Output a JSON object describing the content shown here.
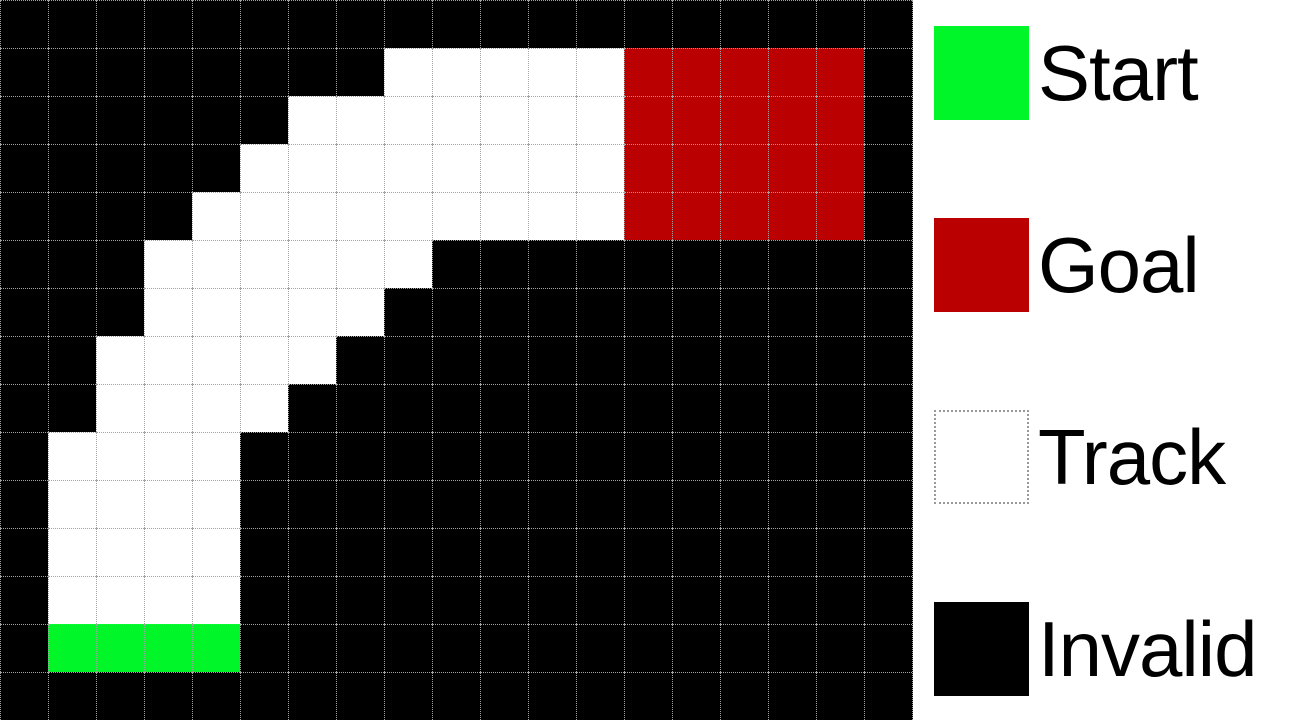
{
  "colors": {
    "start": "#00F629",
    "goal": "#BA0000",
    "track": "#FFFFFF",
    "invalid": "#000000",
    "gridline": "#A3A3A3",
    "legend_background": "#FFFFFF"
  },
  "legend": {
    "items": [
      {
        "label": "Start",
        "color_key": "start"
      },
      {
        "label": "Goal",
        "color_key": "goal"
      },
      {
        "label": "Track",
        "color_key": "track"
      },
      {
        "label": "Invalid",
        "color_key": "invalid"
      }
    ]
  },
  "grid": {
    "cols": 19,
    "rows": 15,
    "cell_size": 48,
    "cell_legend": {
      "B": "invalid",
      "T": "track",
      "S": "start",
      "G": "goal"
    },
    "map": [
      "BBBBBBBBBBBBBBBBBBB",
      "BBBBBBBBTTTTTGGGGGB",
      "BBBBBBTTTTTTTGGGGGB",
      "BBBBBTTTTTTTTGGGGGB",
      "BBBBTTTTTTTTTGGGGGB",
      "BBBTTTTTTBBBBBBBBBB",
      "BBBTTTTTBBBBBBBBBBB",
      "BBTTTTTBBBBBBBBBBBB",
      "BBTTTTBBBBBBBBBBBBB",
      "BTTTTBBBBBBBBBBBBBB",
      "BTTTTBBBBBBBBBBBBBB",
      "BTTTTBBBBBBBBBBBBBB",
      "BTTTTBBBBBBBBBBBBBB",
      "BSSSSBBBBBBBBBBBBBB",
      "BBBBBBBBBBBBBBBBBBB"
    ]
  }
}
